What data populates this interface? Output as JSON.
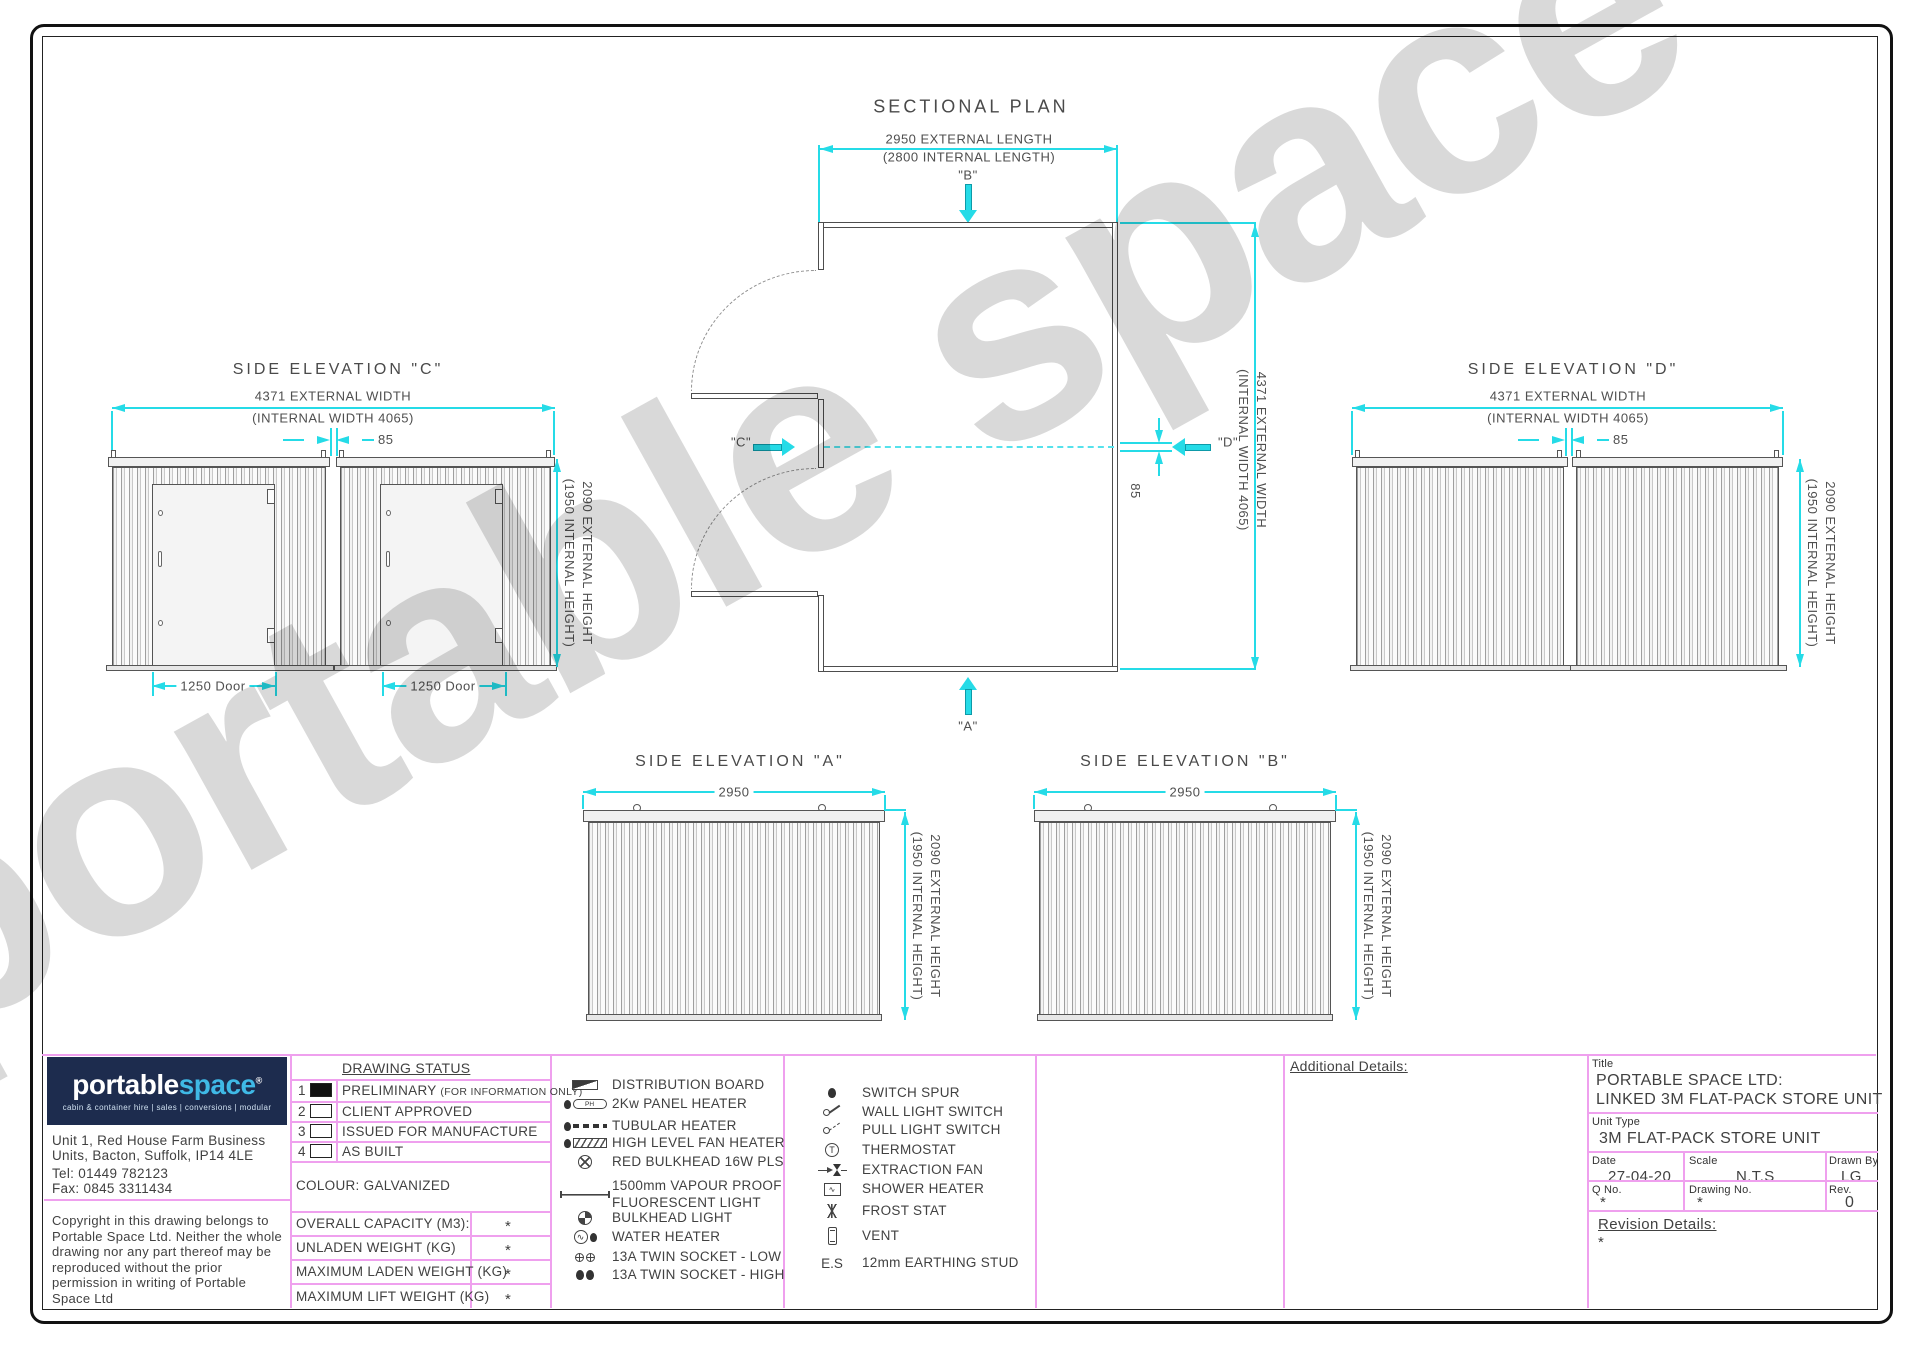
{
  "watermark": "portable space",
  "plan": {
    "title": "SECTIONAL PLAN",
    "dim_length_line1": "2950 EXTERNAL LENGTH",
    "dim_length_line2": "(2800 INTERNAL LENGTH)",
    "dim_width_line1": "4371 EXTERNAL WIDTH",
    "dim_width_line2": "(INTERNAL WIDTH 4065)",
    "dim_gap": "85",
    "marker_a": "\"A\"",
    "marker_b": "\"B\"",
    "marker_c": "\"C\"",
    "marker_d": "\"D\""
  },
  "elevations": {
    "c_title": "SIDE ELEVATION \"C\"",
    "d_title": "SIDE ELEVATION \"D\"",
    "a_title": "SIDE ELEVATION \"A\"",
    "b_title": "SIDE ELEVATION \"B\"",
    "dim_width_line1": "4371 EXTERNAL WIDTH",
    "dim_width_line2": "(INTERNAL WIDTH 4065)",
    "dim_height_line1": "2090 EXTERNAL HEIGHT",
    "dim_height_line2": "(1950 INTERNAL HEIGHT)",
    "dim_gap": "85",
    "dim_length": "2950",
    "dim_door": "1250 Door"
  },
  "legend": {
    "ph_text": "PH",
    "wh_text": "∿",
    "sh_text": "∿",
    "th_text": "T",
    "left": [
      {
        "label": "DISTRIBUTION BOARD"
      },
      {
        "label": "2Kw PANEL HEATER"
      },
      {
        "label": "TUBULAR HEATER"
      },
      {
        "label": "HIGH LEVEL FAN HEATER"
      },
      {
        "label": "RED BULKHEAD 16W PLS"
      },
      {
        "label": "1500mm VAPOUR PROOF FLUORESCENT LIGHT"
      },
      {
        "label": "BULKHEAD LIGHT"
      },
      {
        "label": "WATER HEATER"
      },
      {
        "label": "13A TWIN SOCKET - LOW"
      },
      {
        "label": "13A TWIN SOCKET - HIGH"
      }
    ],
    "right": [
      {
        "label": "SWITCH SPUR"
      },
      {
        "label": "WALL LIGHT SWITCH"
      },
      {
        "label": "PULL LIGHT SWITCH"
      },
      {
        "label": "THERMOSTAT"
      },
      {
        "label": "EXTRACTION FAN"
      },
      {
        "label": "SHOWER HEATER"
      },
      {
        "label": "FROST STAT"
      },
      {
        "label": "VENT"
      },
      {
        "label": "12mm EARTHING STUD",
        "prefix": "E.S"
      }
    ]
  },
  "status": {
    "header": "DRAWING STATUS",
    "rows": [
      {
        "num": "1",
        "label": "PRELIMINARY",
        "suffix": "(FOR INFORMATION ONLY)",
        "checked": true
      },
      {
        "num": "2",
        "label": "CLIENT APPROVED",
        "checked": false
      },
      {
        "num": "3",
        "label": "ISSUED FOR MANUFACTURE",
        "checked": false
      },
      {
        "num": "4",
        "label": "AS BUILT",
        "checked": false
      }
    ],
    "colour": "COLOUR: GALVANIZED",
    "weights": [
      {
        "label": "OVERALL CAPACITY (M3):",
        "value": "*"
      },
      {
        "label": "UNLADEN WEIGHT (KG)",
        "value": "*"
      },
      {
        "label": "MAXIMUM LADEN WEIGHT (KG)",
        "value": "*"
      },
      {
        "label": "MAXIMUM LIFT WEIGHT (KG)",
        "value": "*"
      }
    ]
  },
  "company": {
    "logo_part1": "portable",
    "logo_part2": "space",
    "logo_reg": "®",
    "tagline": "cabin & container hire | sales | conversions | modular",
    "address_line1": "Unit 1, Red House Farm Business",
    "address_line2": "Units, Bacton, Suffolk, IP14 4LE",
    "tel": "Tel: 01449 782123",
    "fax": "Fax: 0845 3311434",
    "copyright": "Copyright in this drawing belongs to Portable Space Ltd. Neither the whole drawing nor any part thereof may be reproduced without the prior permission in writing of Portable Space Ltd"
  },
  "titleblock": {
    "additional_label": "Additional Details:",
    "title_label": "Title",
    "title_line1": "PORTABLE SPACE LTD:",
    "title_line2": "LINKED 3M FLAT-PACK STORE UNIT",
    "unit_type_label": "Unit Type",
    "unit_type": "3M FLAT-PACK STORE UNIT",
    "date_label": "Date",
    "date": "27-04-20",
    "scale_label": "Scale",
    "scale": "N.T.S",
    "drawn_label": "Drawn By",
    "drawn": "LG",
    "qno_label": "Q No.",
    "qno": "*",
    "drawing_no_label": "Drawing No.",
    "drawing_no": "*",
    "rev_label": "Rev.",
    "rev": "0",
    "revision_label": "Revision Details:",
    "revision_value": "*"
  }
}
